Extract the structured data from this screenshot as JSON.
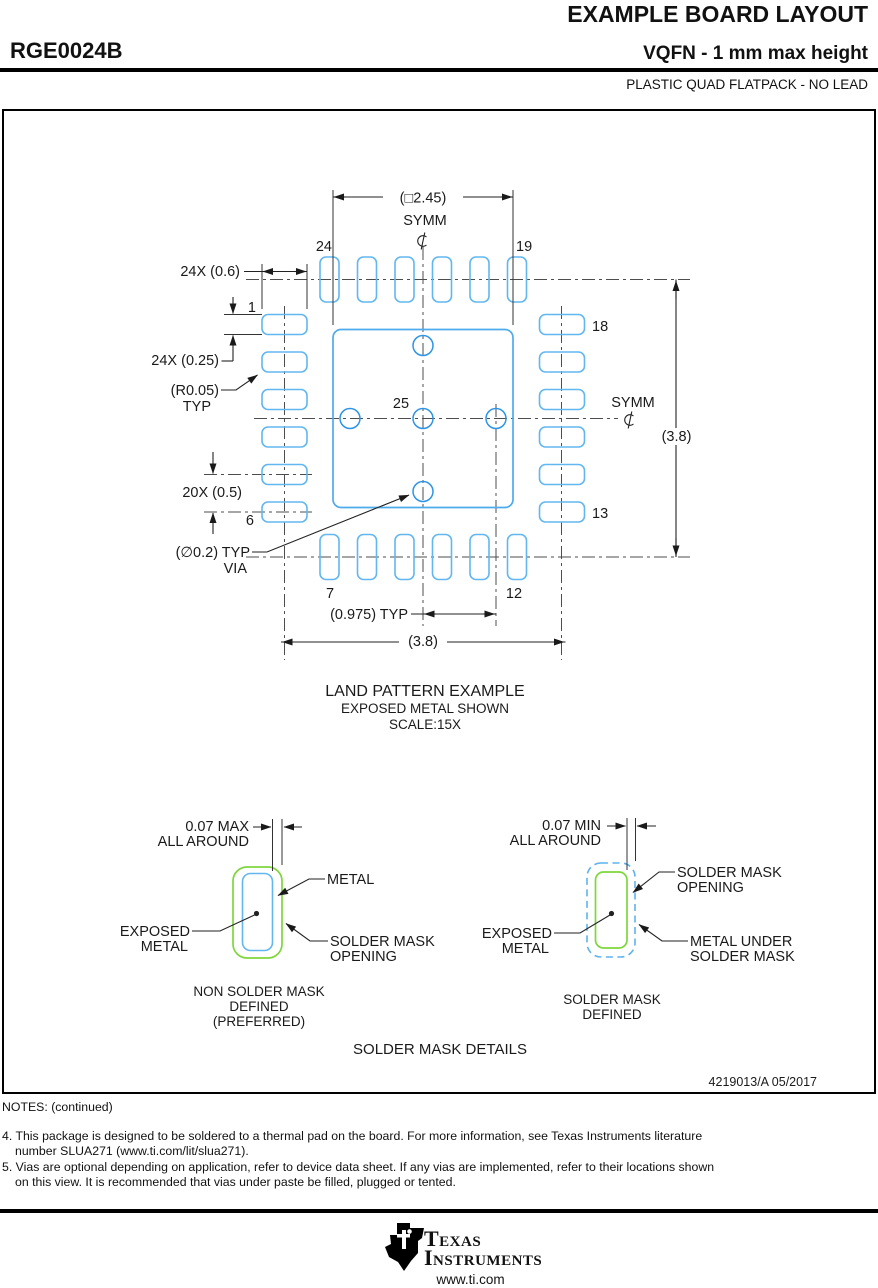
{
  "header": {
    "doc_title": "EXAMPLE BOARD LAYOUT",
    "part_number": "RGE0024B",
    "package_title": "VQFN - 1 mm max height",
    "package_subtitle": "PLASTIC QUAD FLATPACK - NO LEAD"
  },
  "diagram": {
    "dim_square": "(□2.45)",
    "dim_24x06": "24X (0.6)",
    "dim_24x025": "24X (0.25)",
    "dim_r005": "(R0.05)",
    "typ": "TYP",
    "dim_20x05": "20X (0.5)",
    "dim_via": "(∅0.2) TYP",
    "via_word": "VIA",
    "dim_0975": "(0.975) TYP",
    "dim_38_right": "(3.8)",
    "dim_38_bottom": "(3.8)",
    "symm": "SYMM",
    "pins": {
      "p1": "1",
      "p6": "6",
      "p7": "7",
      "p12": "12",
      "p13": "13",
      "p18": "18",
      "p19": "19",
      "p24": "24",
      "p25": "25"
    },
    "caption_line1": "LAND PATTERN EXAMPLE",
    "caption_line2": "EXPOSED METAL SHOWN",
    "caption_line3": "SCALE:15X"
  },
  "solder_mask": {
    "nsmd": {
      "dim_line1": "0.07 MAX",
      "dim_line2": "ALL AROUND",
      "metal": "METAL",
      "exposed_line1": "EXPOSED",
      "exposed_line2": "METAL",
      "opening_line1": "SOLDER MASK",
      "opening_line2": "OPENING",
      "caption_line1": "NON SOLDER MASK",
      "caption_line2": "DEFINED",
      "caption_line3": "(PREFERRED)"
    },
    "smd": {
      "dim_line1": "0.07 MIN",
      "dim_line2": "ALL AROUND",
      "opening_line1": "SOLDER MASK",
      "opening_line2": "OPENING",
      "exposed_line1": "EXPOSED",
      "exposed_line2": "METAL",
      "under_line1": "METAL UNDER",
      "under_line2": "SOLDER MASK",
      "caption_line1": "SOLDER MASK",
      "caption_line2": "DEFINED"
    },
    "title": "SOLDER MASK DETAILS"
  },
  "doc_number": "4219013/A   05/2017",
  "notes": {
    "title": "NOTES: (continued)",
    "n4a": "4. This package is designed to be soldered to a thermal pad on the board. For more information, see Texas Instruments literature",
    "n4b": "number SLUA271 (www.ti.com/lit/slua271).",
    "n5a": "5. Vias are optional depending on application, refer to device data sheet. If any vias are implemented, refer to their locations shown",
    "n5b": "on this view. It is recommended that vias under paste be filled, plugged or tented."
  },
  "footer": {
    "brand_line1": "Texas",
    "brand_line2": "Instruments",
    "url": "www.ti.com"
  },
  "colors": {
    "pad_blue": "#62b7ef",
    "thermal_blue": "#4dabee",
    "via_blue": "#2e95e6",
    "mask_green": "#7ed63c",
    "ink": "#1a1a1a"
  }
}
